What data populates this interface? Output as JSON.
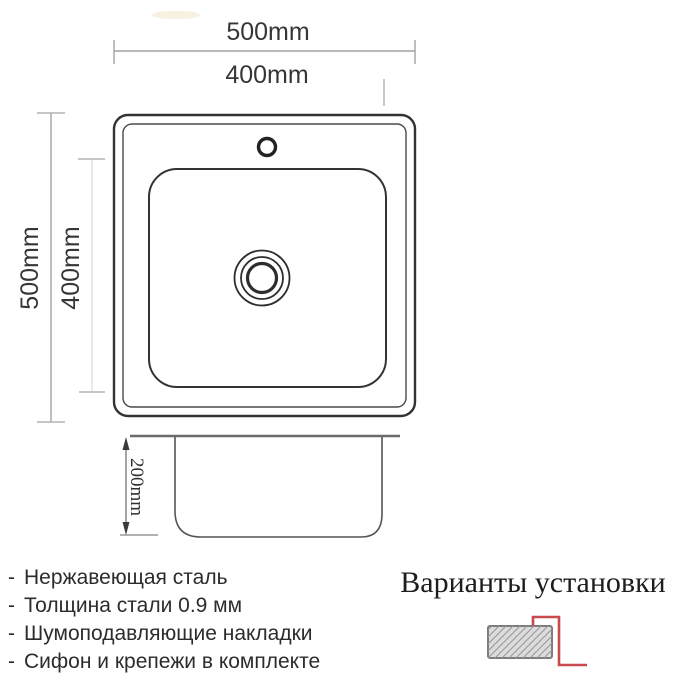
{
  "top_view": {
    "width_label": "500mm",
    "bowl_width_label": "400mm",
    "height_label": "500mm",
    "bowl_height_label": "400mm"
  },
  "side_view": {
    "depth_label": "200mm"
  },
  "features": {
    "bullet": "-",
    "items": [
      "Нержавеющая сталь",
      "Толщина стали 0.9 мм",
      "Шумоподавляющие накладки",
      "Сифон и крепежи в комплекте"
    ]
  },
  "installation": {
    "title": "Варианты установки"
  },
  "colors": {
    "drawing_line": "#333333",
    "rim_line": "#6b6b6b",
    "dimension_line": "#9a9a9a",
    "faint_dimension_line": "#d8d8d8",
    "accent_red": "#c84a4f",
    "hatch_fill": "#dcdcdc",
    "hatch_line": "#999999",
    "text": "#2c2c2c",
    "smudge": "#f5eedb"
  }
}
